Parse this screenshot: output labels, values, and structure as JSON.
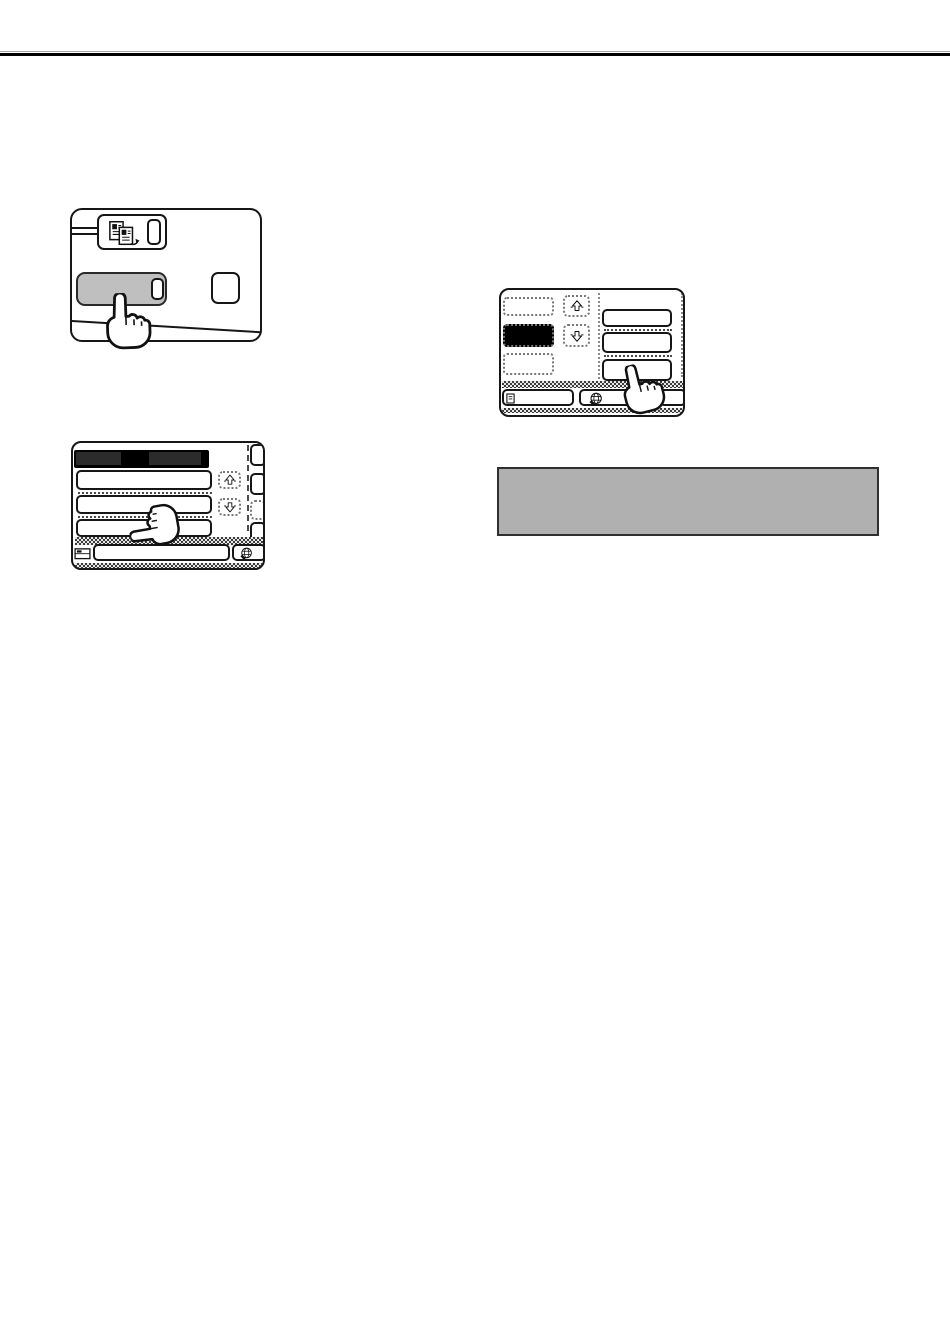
{
  "document": {
    "kind": "operation-manual-page-with-illustrations",
    "background": "#ffffff"
  },
  "top_rule": {
    "style": "double-line",
    "thin_color": "#a6a6a6",
    "thick_color": "#000000"
  },
  "colors": {
    "panel_outline": "#161616",
    "highlighted_key_fill": "#bfbfbf",
    "screen_header_fill": "#000000",
    "screen_header_text_blob": "#2b2b2b",
    "selected_key_fill": "#000000",
    "note_box_fill": "#b0b0b0",
    "note_box_border": "#2f2f2f",
    "dither_dark": "#3b3b3b",
    "dither_light": "#e8e8e8"
  },
  "figures": {
    "panel": {
      "label": "control panel with highlighted mode key being pressed",
      "icons": [
        "document-copy-icon"
      ],
      "keys": [
        "mode-key-group",
        "indicator-slot",
        "highlighted-key",
        "function-key"
      ]
    },
    "screen1": {
      "label": "touch screen with black title bar, three list rows, scroll keys and bottom keys being pressed",
      "icons": [
        "scroll-up-icon",
        "scroll-down-icon",
        "tray-icon",
        "globe-icon"
      ],
      "keys": [
        "list-row-1",
        "list-row-2",
        "list-row-3",
        "scroll-up-key",
        "scroll-down-key",
        "side-key-1",
        "side-key-2",
        "side-key-3",
        "side-key-4",
        "wide-bottom-key",
        "globe-key"
      ]
    },
    "screen2": {
      "label": "touch screen with selected black item, scroll keys and right option keys being pressed",
      "icons": [
        "scroll-up-icon",
        "scroll-down-icon",
        "minidoc-icon",
        "globe-icon"
      ],
      "keys": [
        "item-key-1",
        "item-key-2-selected",
        "item-key-3",
        "scroll-up-key",
        "scroll-down-key",
        "option-key-1",
        "option-key-2",
        "option-key-3",
        "bottom-left-key",
        "globe-key",
        "bottom-right-key"
      ]
    },
    "note": {
      "label": "gray note box",
      "fill": "#b0b0b0"
    }
  },
  "cursor": {
    "label": "pressing-hand-cursor",
    "count": 3
  }
}
